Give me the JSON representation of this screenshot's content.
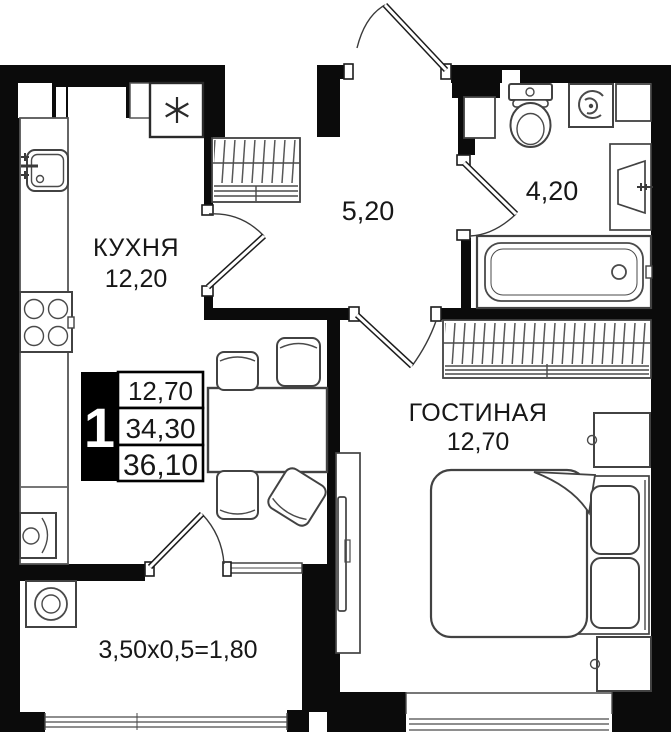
{
  "plan": {
    "labels": {
      "kitchen_name": "КУХНЯ",
      "kitchen_area": "12,20",
      "living_name": "ГОСТИНАЯ",
      "living_area": "12,70",
      "hallway_area": "5,20",
      "bathroom_area": "4,20",
      "balcony_calc": "3,50x0,5=1,80"
    },
    "info_box": {
      "rooms_count": "1",
      "row1": "12,70",
      "row2": "34,30",
      "row3": "36,10"
    },
    "colors": {
      "wall": "#0b0b0b",
      "furniture": "#424242",
      "text": "#171717",
      "background": "#ffffff"
    }
  }
}
